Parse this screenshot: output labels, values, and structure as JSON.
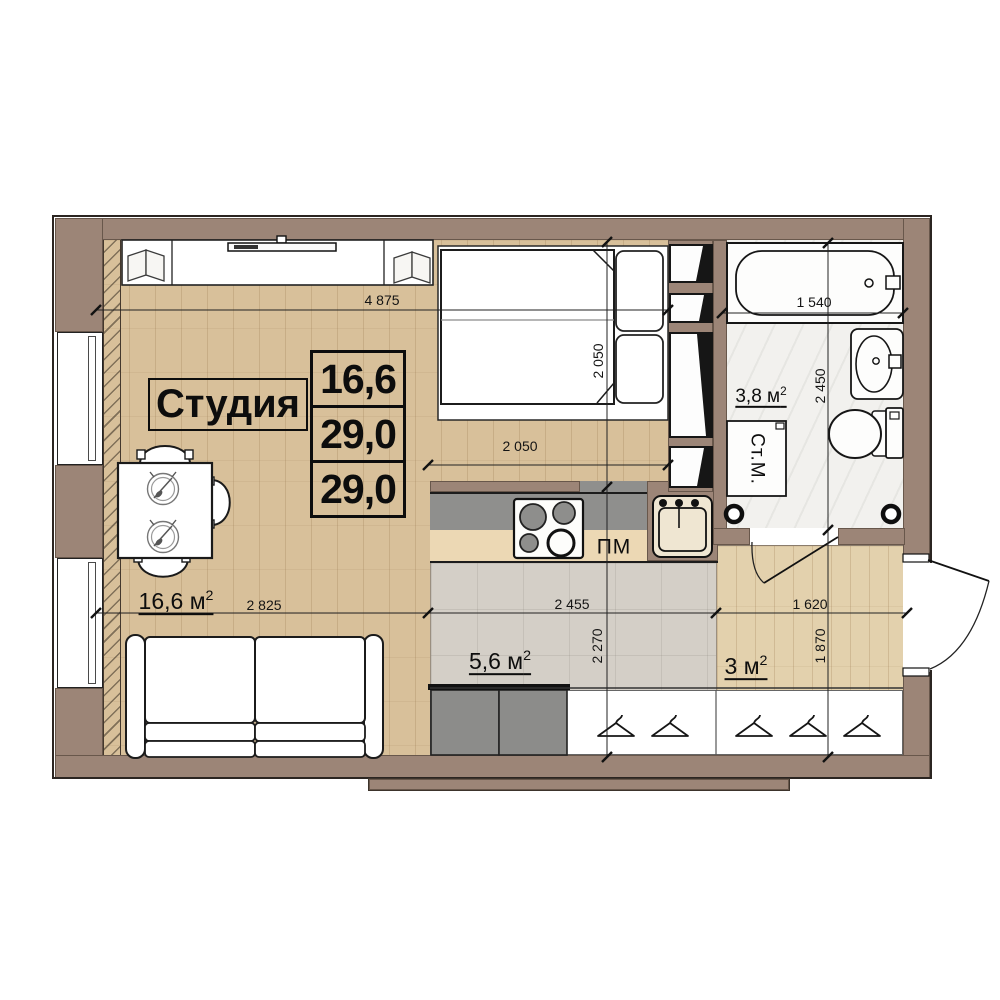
{
  "title": "Студия",
  "area_table": {
    "row1": "16,6",
    "row2": "29,0",
    "row3": "29,0"
  },
  "rooms": {
    "living": {
      "area": "16,6 м",
      "sup": "2"
    },
    "kitchen": {
      "area": "5,6 м",
      "sup": "2"
    },
    "hallway": {
      "area": "3 м",
      "sup": "2"
    },
    "bathroom": {
      "area": "3,8 м",
      "sup": "2"
    }
  },
  "appliances": {
    "dishwasher": "ПМ",
    "washing_machine": "Ст.М."
  },
  "dims": {
    "studio_width": "4 875",
    "bed_width": "2 050",
    "bed_length": "2 050",
    "bath_length": "1 540",
    "bathroom_depth": "2 450",
    "living_width": "2 825",
    "kitchen_width": "2 455",
    "kitchen_depth": "2 270",
    "hall_width": "1 620",
    "hall_depth": "1 870"
  },
  "palette": {
    "wall": "#9c8577",
    "outline": "#2b2521",
    "wood_floor": "#d8c09a",
    "hall_wood_floor": "#e3d1ad",
    "kitchen_tile": "#d4cfc7",
    "bath_floor": "#f2f1ee",
    "counter_dark": "#8f8f8d",
    "counter_wood": "#ecd8b4",
    "cabinet_gray": "#8c8c8a",
    "linework": "#111111"
  }
}
